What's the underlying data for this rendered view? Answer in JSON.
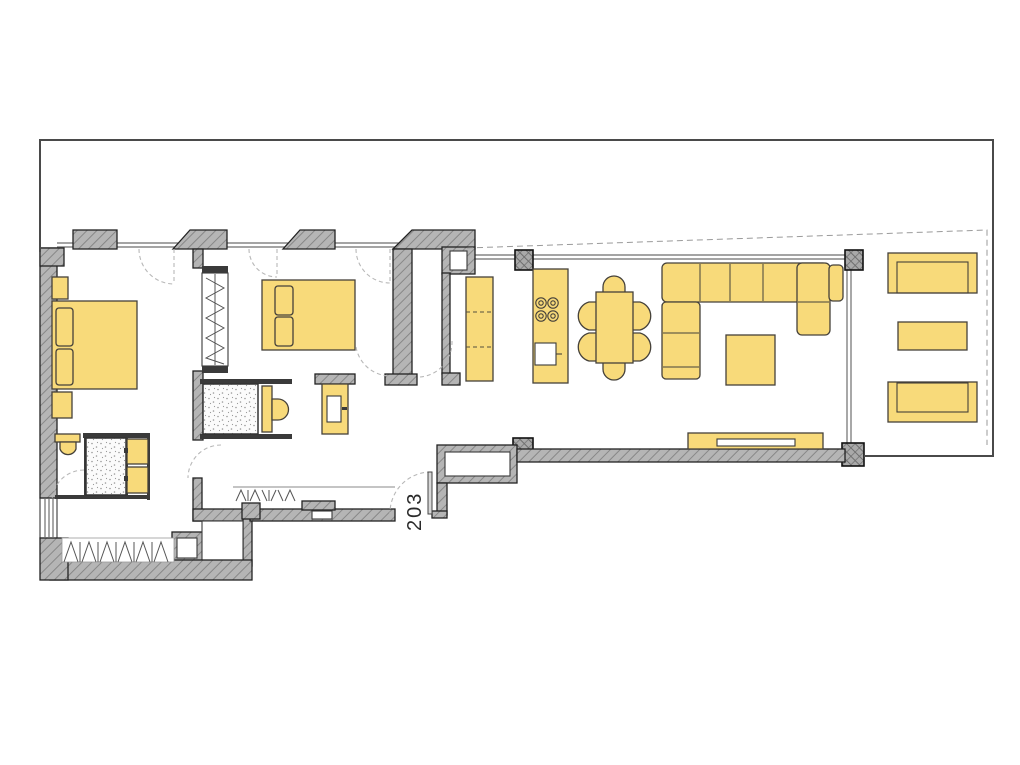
{
  "plan": {
    "unit_label": "203"
  },
  "colors": {
    "background": "#ffffff",
    "furniture_fill": "#f8da7a",
    "furniture_outline": "#45413a",
    "wall_fill": "#b5b5b5",
    "wall_hatch": "#878787",
    "wall_outline": "#222222",
    "boundary_line": "#4a4a4a",
    "window_line": "#6e6e6e",
    "door_arc": "#b8b8b8",
    "shower_dot": "#9a9a9a"
  },
  "furniture": {
    "master_bedroom": [
      "double-bed",
      "pillow",
      "pillow",
      "nightstand",
      "nightstand",
      "wardrobe"
    ],
    "ensuite_bathroom": [
      "toilet",
      "shower",
      "vanity-basin",
      "vanity-basin"
    ],
    "second_bedroom": [
      "double-bed",
      "pillow",
      "pillow"
    ],
    "second_bathroom": [
      "shower",
      "toilet"
    ],
    "hallway": [
      "washbasin",
      "coat-closet",
      "wardrobe-closet",
      "entry-door"
    ],
    "kitchen": [
      "wall-counter",
      "island-hob-4-burners",
      "island-sink"
    ],
    "dining": [
      "table",
      "chair",
      "chair",
      "chair",
      "chair",
      "chair",
      "chair"
    ],
    "living": [
      "corner-sofa",
      "coffee-table",
      "tv-sideboard"
    ],
    "terrace": [
      "sun-lounger",
      "side-table",
      "sun-lounger"
    ]
  }
}
